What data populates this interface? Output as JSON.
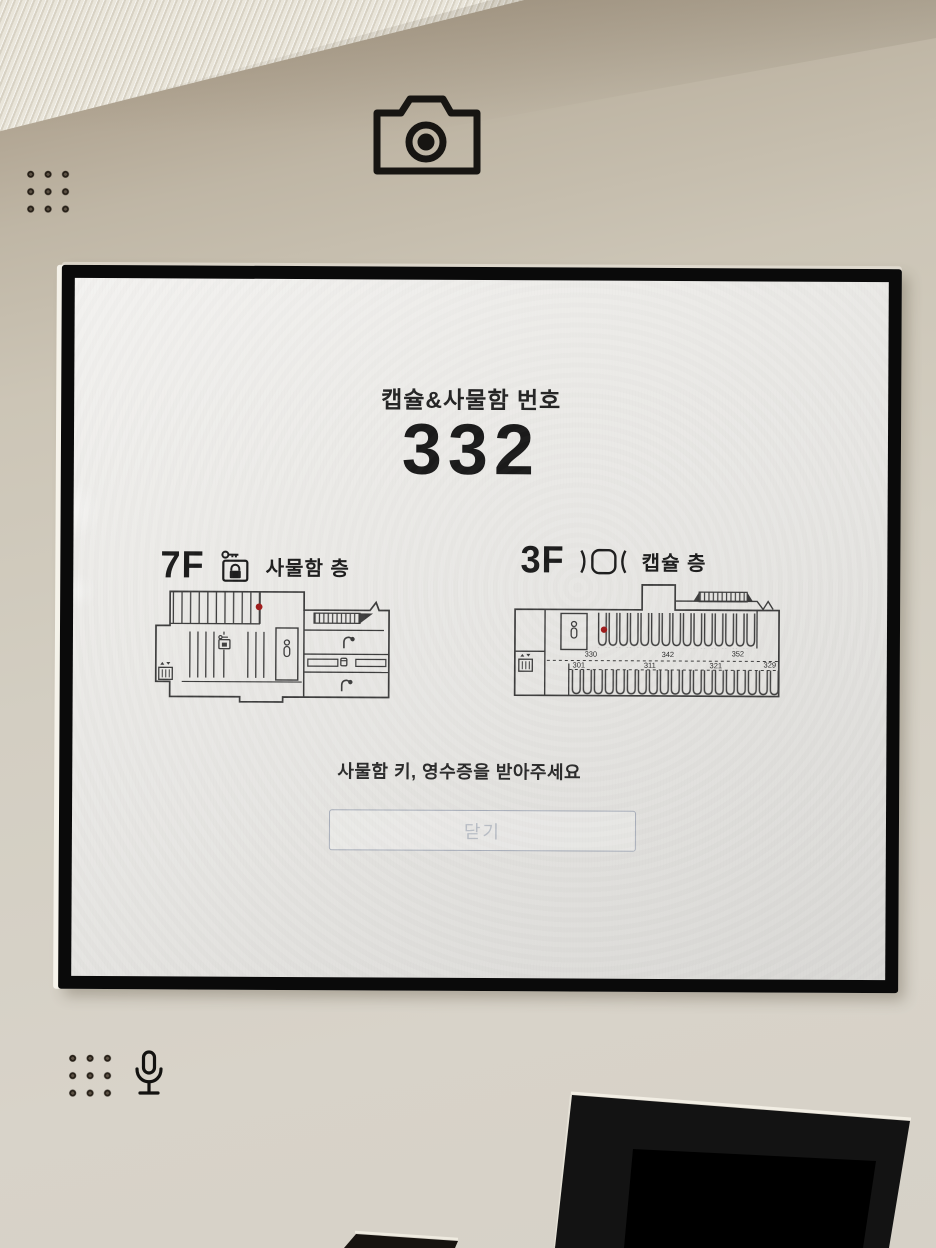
{
  "device": {
    "icons": {
      "camera": "camera-icon",
      "speaker_grid_top": "speaker-holes",
      "microphone_grid": "mic-holes",
      "microphone": "microphone-icon"
    }
  },
  "screen": {
    "title": "캡슐&사물함 번호",
    "assigned_number": "332",
    "message": "사물함 키, 영수증을 받아주세요",
    "close_button_label": "닫기",
    "colors": {
      "marker": "#9e1b1b",
      "map_line": "#3d3d3d",
      "screen_bg": "#e9e8e5",
      "bezel": "#0a0a0a",
      "body_panel": "#cfc9bc"
    },
    "floors": [
      {
        "floor": "7F",
        "type_label": "사물함 층",
        "icon": "locker-key-icon"
      },
      {
        "floor": "3F",
        "type_label": "캡슐 층",
        "icon": "capsule-icon",
        "top_row_labels": [
          "330",
          "342",
          "352"
        ],
        "bottom_row_labels": [
          "301",
          "311",
          "321",
          "329"
        ]
      }
    ]
  }
}
